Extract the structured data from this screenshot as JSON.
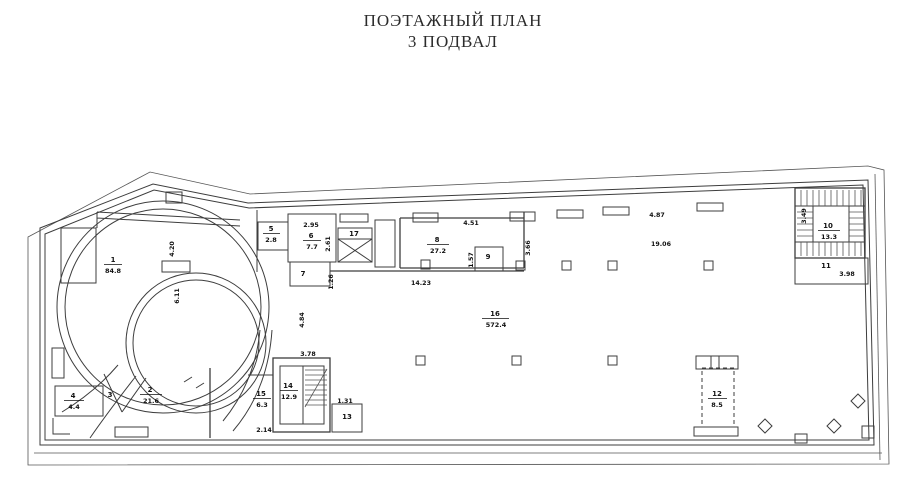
{
  "title": {
    "line1": "ПОЭТАЖНЫЙ ПЛАН",
    "line2": "3 ПОДВАЛ"
  },
  "plan": {
    "rooms": [
      {
        "num": "1",
        "area": "84.8"
      },
      {
        "num": "2",
        "area": "21.6"
      },
      {
        "num": "3",
        "area": ""
      },
      {
        "num": "4",
        "area": "4.4"
      },
      {
        "num": "5",
        "area": "2.8"
      },
      {
        "num": "6",
        "area": "7.7"
      },
      {
        "num": "7",
        "area": ""
      },
      {
        "num": "8",
        "area": "27.2"
      },
      {
        "num": "9",
        "area": ""
      },
      {
        "num": "10",
        "area": "13.3"
      },
      {
        "num": "11",
        "area": ""
      },
      {
        "num": "12",
        "area": "8.5"
      },
      {
        "num": "13",
        "area": ""
      },
      {
        "num": "14",
        "area": "12.9"
      },
      {
        "num": "15",
        "area": "6.3"
      },
      {
        "num": "16",
        "area": "572.4"
      },
      {
        "num": "17",
        "area": ""
      }
    ],
    "dims": {
      "ramp_upper": "4.20",
      "ramp_inner": "6.11",
      "room6_width": "2.95",
      "room6_depth": "2.61",
      "room7_depth": "1.26",
      "room8_top": "4.51",
      "room9_left": "1.57",
      "room8_bottom": "14.23",
      "hall_top_left": "3.66",
      "hall_top_right": "4.87",
      "hall_mid": "19.06",
      "corridor_left": "4.84",
      "stair14_top": "3.78",
      "room15_bottom": "2.14",
      "room13_top": "1.31",
      "stair10_side": "3.49",
      "room11_bottom": "3.98"
    },
    "colors": {
      "line": "#3d3d3d",
      "text": "#111111",
      "background": "#ffffff"
    }
  }
}
